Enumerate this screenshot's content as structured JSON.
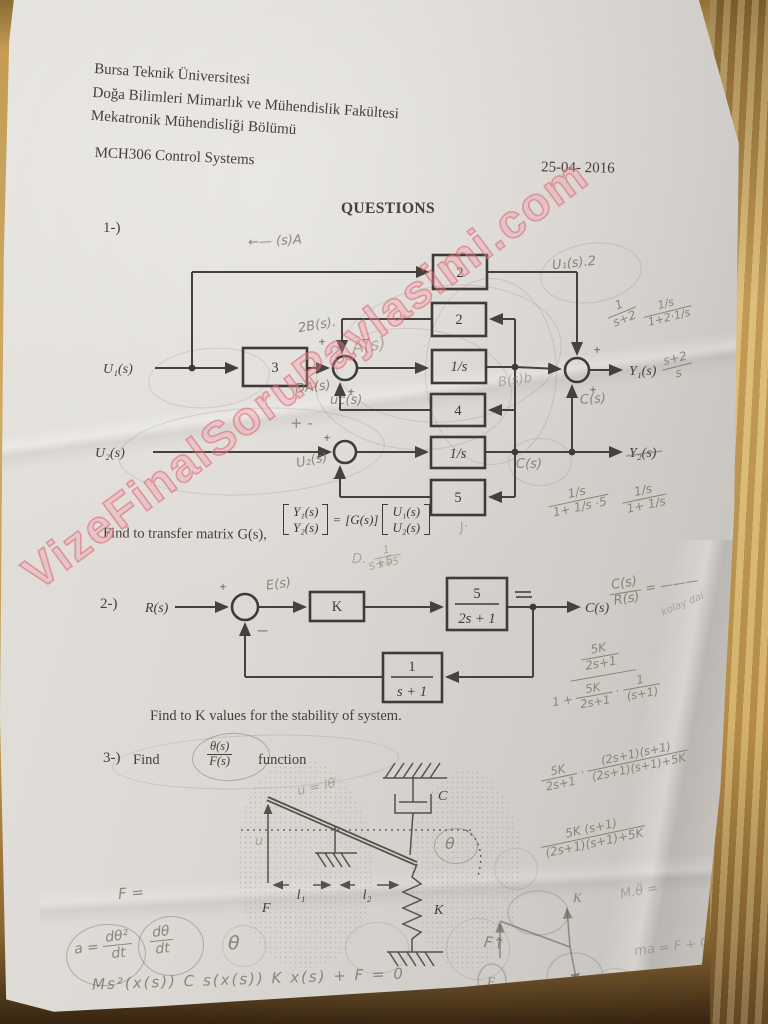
{
  "watermark": {
    "text": "VizeFinalSoruPaylasimi.com"
  },
  "header": {
    "university": "Bursa Teknik Üniversitesi",
    "faculty": "Doğa Bilimleri Mimarlık ve Mühendislik Fakültesi",
    "department": "Mekatronik Mühendisliği Bölümü",
    "course": "MCH306 Control Systems",
    "date": "25-04- 2016"
  },
  "title": "QUESTIONS",
  "sym": {
    "plus": "+",
    "minus": "−"
  },
  "q1": {
    "label": "1-)",
    "u1": "U₁(s)",
    "u2": "U₂(s)",
    "y1": "Y₁(s)",
    "y2": "Y₂(s)",
    "blocks": [
      "3",
      "2",
      "2",
      "1/s",
      "4",
      "1/s",
      "5"
    ],
    "find": "Find to transfer matrix G(s),",
    "matrix": {
      "y1": "Y₁(s)",
      "y2": "Y₂(s)",
      "eq": "=",
      "g": "[G(s)]",
      "u1": "U₁(s)",
      "u2": "U₂(s)"
    }
  },
  "q1_notes": {
    "top_arrow": "←—  (s)A",
    "u1s2": "U₁(s).2",
    "b2s": "2B(s).",
    "as_big": "A(s)",
    "das": "DA(s)",
    "ucs": "uc(s)",
    "bsb": "B(s)b",
    "u2s": "U₂(s)",
    "cs_low": "C(s)",
    "cs_right": "C(s)",
    "pm": "+ -",
    "frac_1": {
      "n": "1",
      "d": "s+2"
    },
    "frac_2": {
      "n": "1/s",
      "d": "1+2·1/s"
    },
    "frac_3": {
      "n": "s+2",
      "d": "s"
    },
    "frac_4": {
      "n": "1/s",
      "d": "1+ 1/s ·5"
    },
    "frac_5": {
      "n": "1/s",
      "d": "1+ 1/s"
    },
    "d_mark": "D.",
    "frac_6": {
      "n": "1",
      "d": "s+5"
    },
    "j_mark": "J·"
  },
  "q2": {
    "label": "2-)",
    "r": "R(s)",
    "e": "E(s)",
    "k": "K",
    "p_num": "5",
    "p_den": "2s + 1",
    "c": "C(s)",
    "f_num": "1",
    "f_den": "s + 1",
    "find": "Find to K values for the stability of system.",
    "note_s5": "s+5"
  },
  "q2_margin": {
    "m1": {
      "n": "C(s)",
      "d": "R(s)",
      "eq": "= ———",
      "word": "kolay dal"
    },
    "big": {
      "nn": "5K",
      "nd": "2s+1",
      "dpre": "1 +",
      "dn1": "5K",
      "dd1": "2s+1",
      "dot": "·",
      "dn2": "1",
      "dd2": "(s+1)"
    },
    "m4": {
      "n1": "5K",
      "d1": "2s+1",
      "dot": "·",
      "n2": "(2s+1)(s+1)",
      "d2": "(2s+1)(s+1)+5K"
    },
    "m5": {
      "n": "5K (s+1)",
      "d": "(2s+1)(s+1)+5K"
    }
  },
  "q3": {
    "label": "3-)",
    "find": "Find",
    "num": "θ(s)",
    "den": "F(s)",
    "suffix": "function",
    "c": "C",
    "k": "K",
    "f": "F",
    "theta": "θ",
    "l1": "l₁",
    "l2": "l₂",
    "u_eq": "u = lθ",
    "u": "u"
  },
  "bottom": {
    "f_left": "F =",
    "a_label": "a =",
    "f1": {
      "n": "dθ²",
      "d": "dt"
    },
    "f2": {
      "n": "dθ",
      "d": "dt"
    },
    "theta": "θ",
    "eq": "Ms²(x(s)) C s(x(s)) K x(s) + F = 0",
    "f_up": "F↑",
    "mtheta": "M.θ̈ =",
    "ma": "ma = F + C − K",
    "sk": {
      "k": "K",
      "c": "C",
      "f": "F"
    },
    "f_small": "F="
  }
}
